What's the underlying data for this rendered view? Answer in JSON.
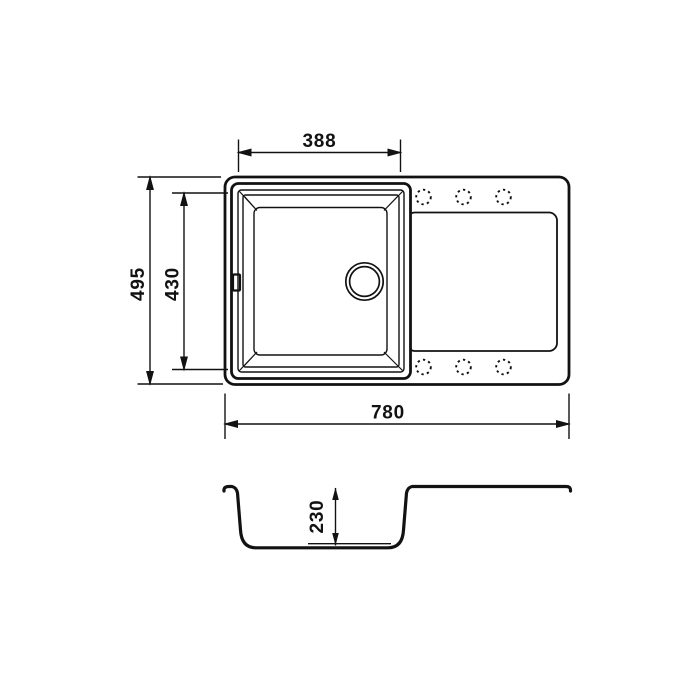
{
  "drawing": {
    "type": "sink-technical-drawing",
    "views": [
      "top-view",
      "section-view"
    ],
    "background_color": "#ffffff",
    "line_color": "#121212"
  },
  "labels": {
    "bowl_width": "388",
    "overall_depth": "495",
    "bowl_depth": "430",
    "overall_width": "780",
    "bowl_height": "230"
  },
  "icons": {
    "drain": "drain-hole-icon",
    "overflow": "overflow-slot-icon",
    "tap_hole": "tap-hole-dashed-circle-icon",
    "drainboard": "drainboard-panel"
  },
  "chart_data": {
    "type": "table",
    "title": "Sink dimensions (mm)",
    "categories": [
      "overall width",
      "overall depth",
      "bowl width",
      "bowl depth",
      "bowl height"
    ],
    "values": [
      780,
      495,
      388,
      430,
      230
    ]
  }
}
